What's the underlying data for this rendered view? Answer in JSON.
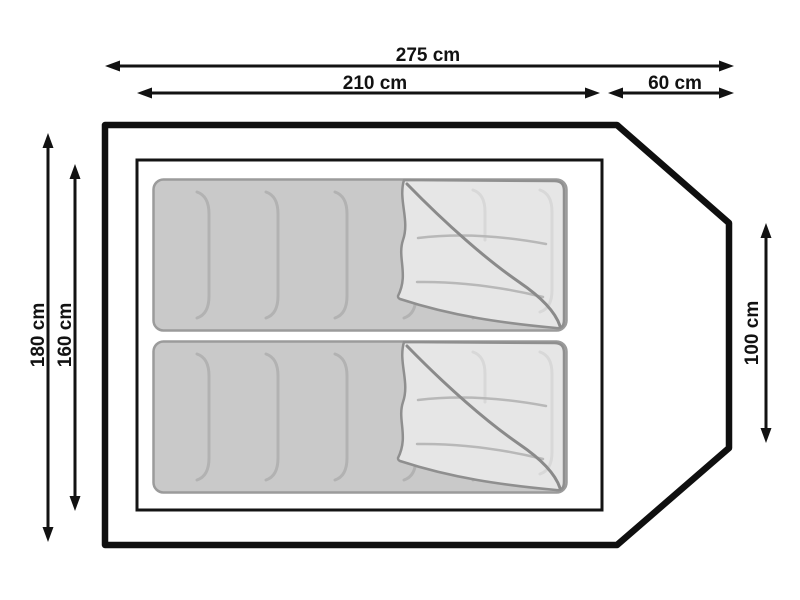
{
  "figure": {
    "type": "tent floor plan (top view) with two sleeping bags",
    "unit": "cm",
    "sleeping_bags_count": 2
  },
  "dims": {
    "total_length": {
      "label": "275 cm",
      "value": 275
    },
    "inner_length": {
      "label": "210 cm",
      "value": 210
    },
    "porch_length": {
      "label": "60 cm",
      "value": 60
    },
    "outer_width": {
      "label": "180 cm",
      "value": 180
    },
    "inner_width": {
      "label": "160 cm",
      "value": 160
    },
    "rear_width": {
      "label": "100 cm",
      "value": 100
    }
  },
  "colors": {
    "background": "#ffffff",
    "outline": "#0f0f0f",
    "dimension_lines": "#121212",
    "bag_fill": "#c9c9c9",
    "bag_border": "#9b9b9b",
    "bag_quilting": "#b2b2b2",
    "flap_fill": "#e6e6e6",
    "flap_edge": "#8a8a8a"
  }
}
